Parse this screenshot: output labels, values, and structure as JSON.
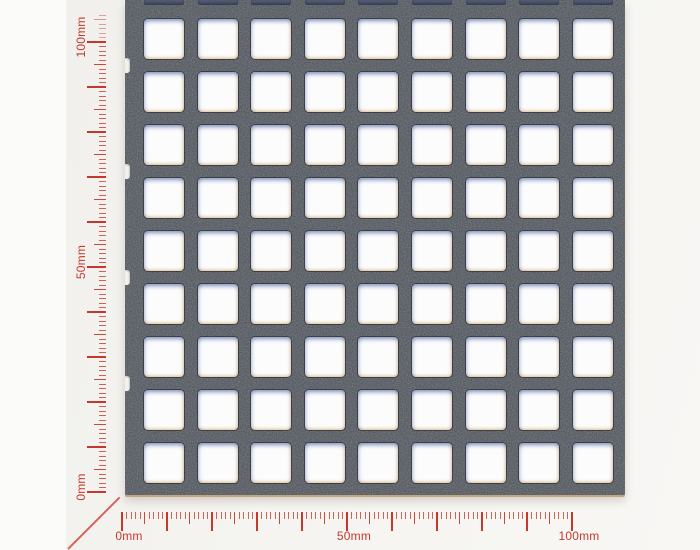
{
  "photo": {
    "subject": "perforated metal sheet sample with square holes",
    "background_page_color": "#fafafa",
    "background_photo_color": "#f3f2ef",
    "plate_color": "#44484f",
    "hole_color": "#fcfcfd",
    "cut_hole_shadow_color": "#515a71"
  },
  "rulers": {
    "unit": "mm",
    "color": "#c5392c",
    "px_per_mm": 4.5,
    "minor_step_mm": 1,
    "medium_step_mm": 5,
    "major_step_mm": 10,
    "horizontal": {
      "mm_start": 0,
      "mm_end": 100,
      "labels": [
        {
          "text": "0mm",
          "mm": 0
        },
        {
          "text": "50mm",
          "mm": 50
        },
        {
          "text": "100mm",
          "mm": 100
        }
      ]
    },
    "vertical": {
      "mm_start": 0,
      "mm_end": 106,
      "faded_above_mm": 100,
      "labels": [
        {
          "text": "0mm",
          "mm": 0
        },
        {
          "text": "50mm",
          "mm": 50
        },
        {
          "text": "100mm",
          "mm": 100
        }
      ]
    }
  },
  "layout": {
    "stage": {
      "width": 700,
      "height": 550
    },
    "photo_left": 66,
    "plate": {
      "left": 125,
      "top": 0,
      "width": 500,
      "height": 495
    },
    "holes": {
      "cols": 9,
      "rows": 9,
      "size": 40,
      "first_x": 144,
      "first_y": 19,
      "pitch_x": 53.6,
      "pitch_y": 53.0,
      "radius": 4
    },
    "slivers": {
      "height": 5
    },
    "notches": {
      "row_gaps": [
        0,
        2,
        4,
        6
      ],
      "width": 5,
      "height": 15
    },
    "ruler_h": {
      "origin_x": 122,
      "tick_top": 512,
      "label_top": 530
    },
    "ruler_v": {
      "origin_y": 492,
      "tick_right": 106,
      "label_center_x": 81
    },
    "tick_len": {
      "minor": 7,
      "medium": 12,
      "major": 19
    },
    "diagonal": {
      "x": 68,
      "y": 548,
      "length": 73,
      "angle_deg": -45
    }
  }
}
